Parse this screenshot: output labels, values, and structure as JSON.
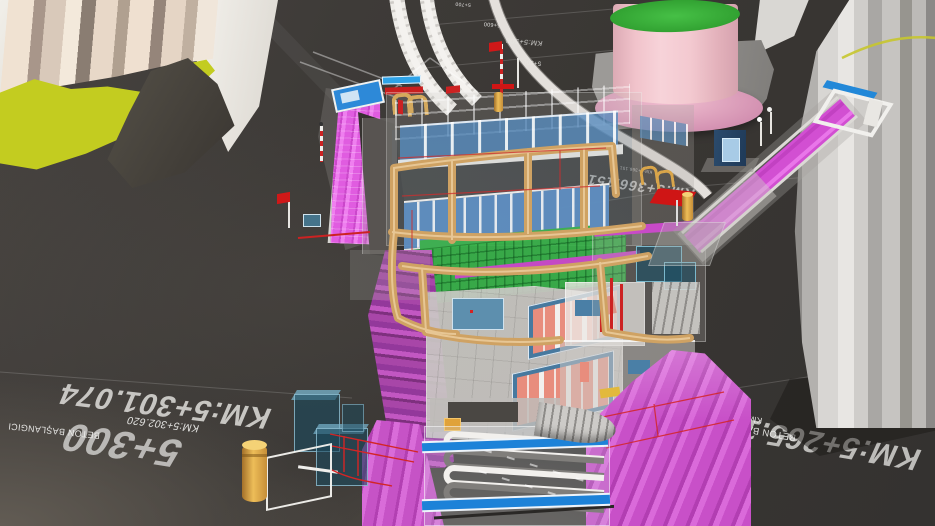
{
  "viewport": {
    "type": "3d-bim-model",
    "subject": "Metro station BIM coordination model (cut-away 3D view)"
  },
  "labels": {
    "chainage_main_left": "KM:5+301.074",
    "grid_left": "5+300",
    "chainage_small_left": "KM:5+302.620",
    "note_left": "BETON BAŞLANGICI",
    "chainage_main_right": "KM:5+265.151",
    "chainage_small_right": "KM:5+265.151",
    "note_right": "BETON BAŞLANGICI",
    "chainage_center": "KM:5+366.151",
    "chainage_center_small": "KM:5+366.151",
    "grid_top": "5+400",
    "chainage_top": "KM:5+401.074",
    "grid_far_1": "5+700",
    "grid_far_2": "5+600",
    "grid_far_3": "5+500",
    "chainage_far": "KM:5+500"
  },
  "colors": {
    "ground": "#3b3834",
    "magenta_escalator": "#d24fd2",
    "purple_platform": "#9b3e9b",
    "copper_duct": "#cfa263",
    "glass_blue": "#5f8fc2",
    "slab_green": "#3cb54a",
    "bar_blue": "#1d82d8",
    "pipe_red": "#cc2222",
    "tank_pink": "#f2c7cd",
    "tank_top_green": "#3bb43b",
    "terrain_chartreuse": "#c3cc20",
    "building_beige": "#f0e2d2",
    "concrete_grey": "#c6c4c0",
    "label_white": "#e8e7e5"
  }
}
